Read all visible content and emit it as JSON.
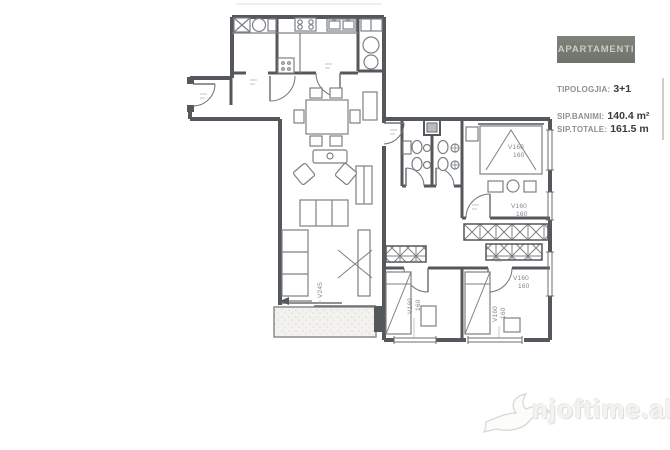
{
  "info_panel": {
    "title": "APARTAMENTI",
    "rows": [
      {
        "label": "TIPOLOGJIA:",
        "value": "3+1"
      },
      {
        "label": "SIP.BANIMI:",
        "value": "140.4 m²"
      },
      {
        "label": "SIP.TOTALE:",
        "value": "161.5 m"
      }
    ]
  },
  "watermark": {
    "text": "njoftime.al",
    "icon": "swallow-bird-icon"
  },
  "floorplan": {
    "labels": {
      "master_window": {
        "l1": "V160",
        "l2": "160"
      },
      "mid_window": {
        "l1": "V160",
        "l2": "160"
      },
      "low_window": {
        "l1": "V160",
        "l2": "160"
      },
      "bed2_window": {
        "l1": "V160",
        "l2": "160"
      },
      "bed3_window": {
        "l1": "V160",
        "l2": "160"
      },
      "living_window": {
        "l1": "V245"
      }
    }
  },
  "colors": {
    "wall": "#54575b",
    "furniture_line": "#7d8082",
    "panel_bg": "#757b72",
    "panel_title_text": "#c9cdc2",
    "label_gray": "#8f8f8d",
    "value_dark": "#3b3b3b",
    "watermark_text": "#f3f3f1"
  }
}
